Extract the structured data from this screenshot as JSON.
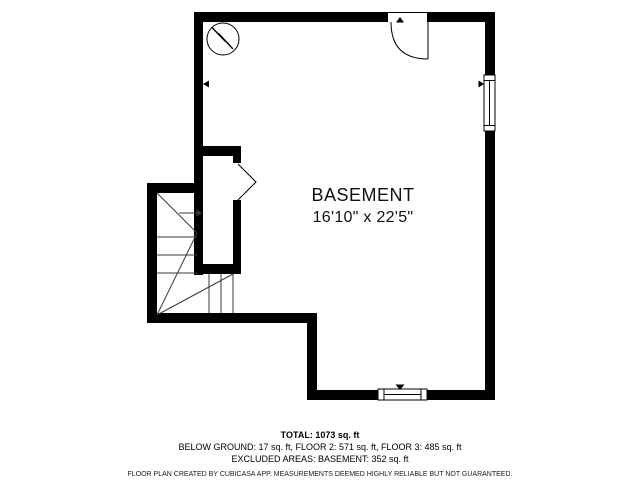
{
  "floor_plan": {
    "room": {
      "name": "BASEMENT",
      "dimensions": "16'10\" x 22'5\""
    },
    "symbols": [
      "door-swing-icon",
      "bifold-door-icon",
      "window-icon",
      "staircase-icon",
      "utility-circle-icon",
      "wall-marker-triangle-icon"
    ],
    "colors": {
      "wall": "#000000",
      "background": "#ffffff",
      "stair_line": "#3a3a3a",
      "text": "#111111"
    }
  },
  "footer": {
    "total": "TOTAL: 1073 sq. ft",
    "areas": "BELOW GROUND: 17 sq. ft, FLOOR 2: 571 sq. ft, FLOOR 3: 485 sq. ft",
    "excluded": "EXCLUDED AREAS: BASEMENT: 352 sq. ft",
    "disclaimer": "FLOOR PLAN CREATED BY CUBICASA APP. MEASUREMENTS DEEMED HIGHLY RELIABLE BUT NOT GUARANTEED."
  }
}
